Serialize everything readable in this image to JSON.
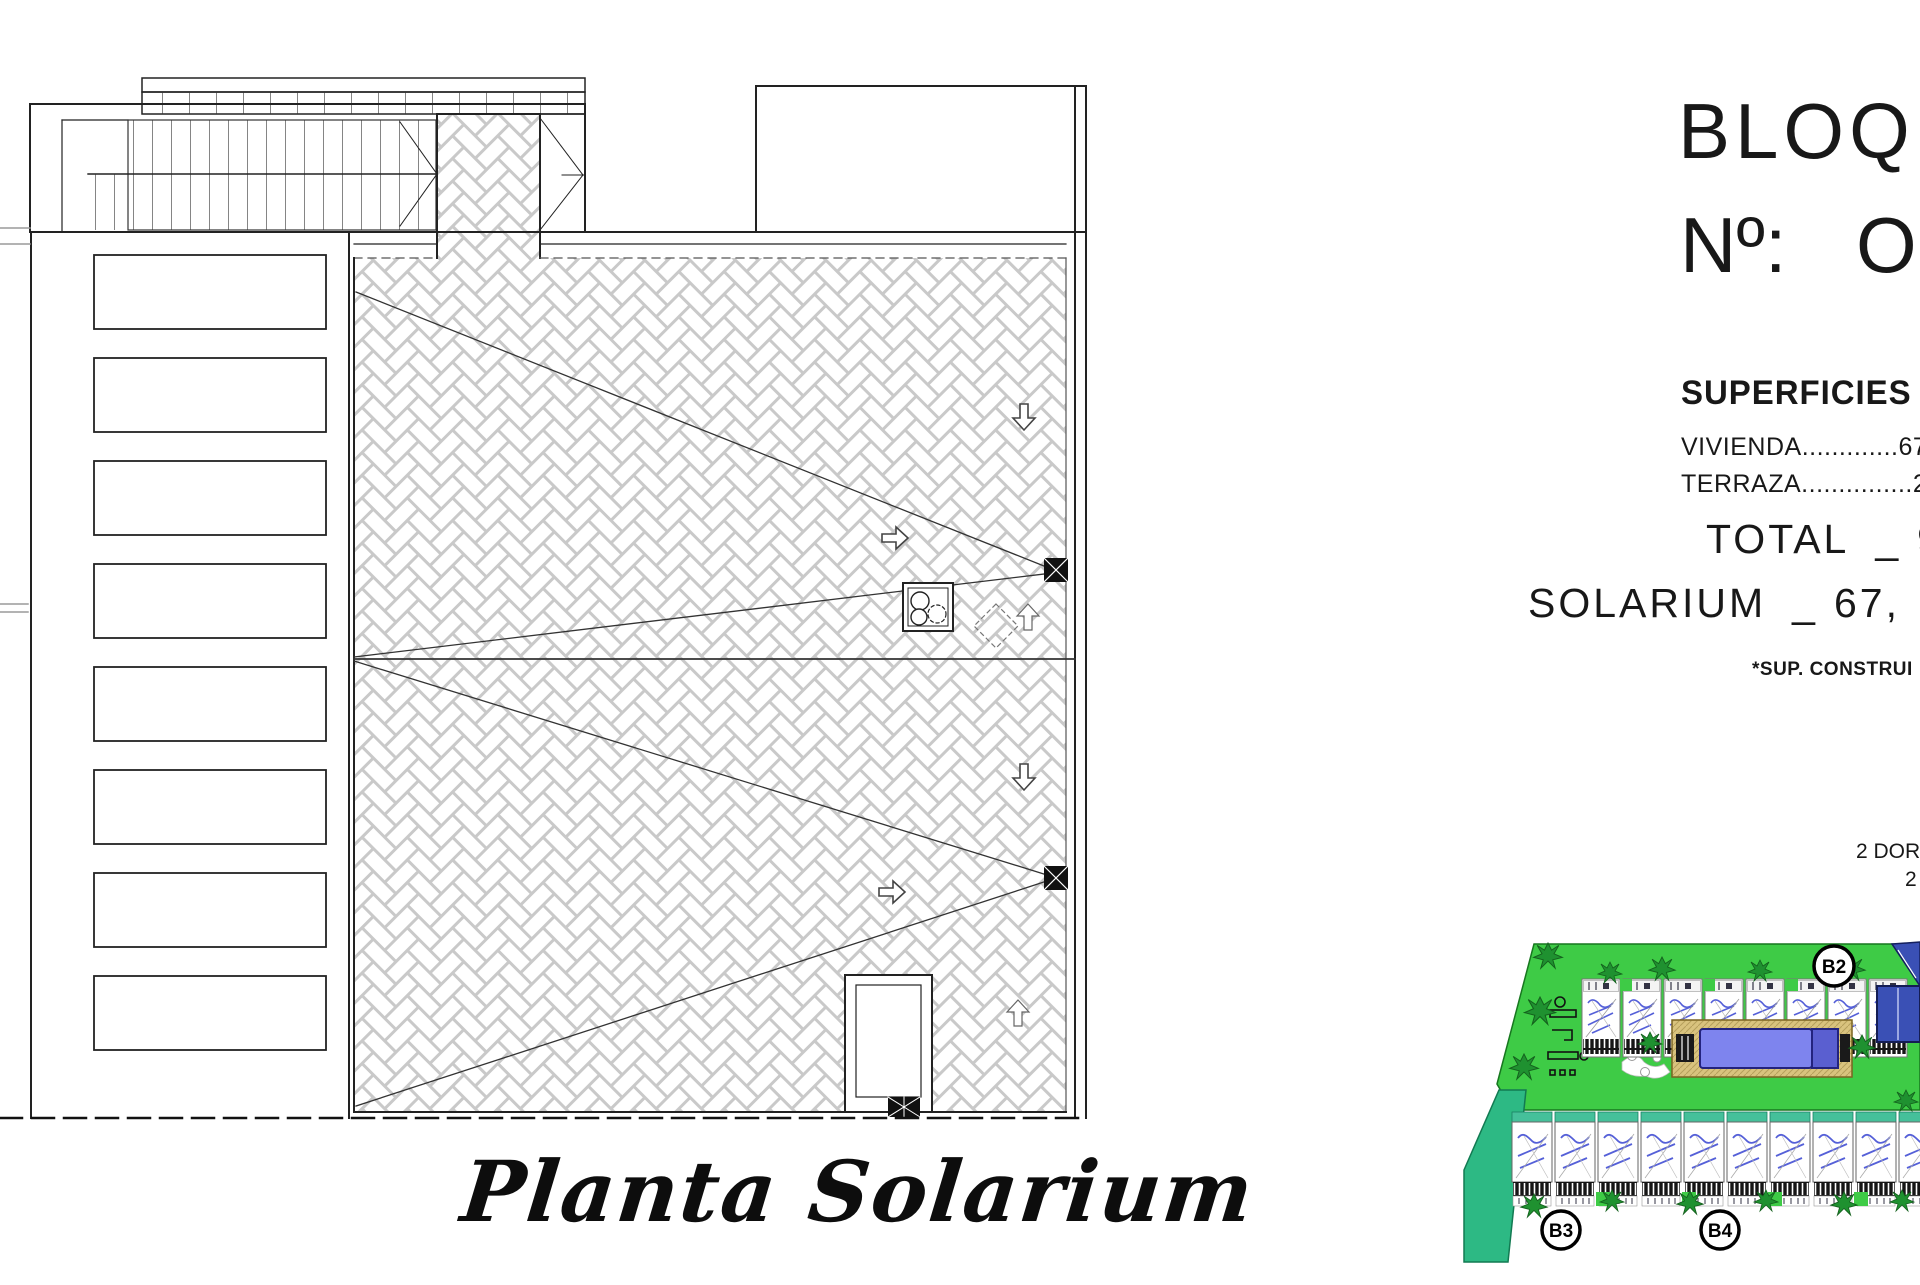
{
  "plan": {
    "caption": "Planta Solarium"
  },
  "info_panel": {
    "bloque_label": "BLOQ",
    "numero_label": "Nº:",
    "numero_value": "O",
    "superficies_label": "SUPERFICIES",
    "lines": [
      "VIVIENDA.............67",
      "TERRAZA...............27"
    ],
    "total": {
      "label": "TOTAL",
      "sep": "_",
      "value": "94"
    },
    "solarium": {
      "label": "SOLARIUM",
      "sep": "_",
      "value": "67,"
    },
    "note": "*SUP. CONSTRUI",
    "dorm_line_1": "2 DORM",
    "dorm_line_2": "2"
  },
  "site_plan": {
    "labels": {
      "b2": "B2",
      "b3": "B3",
      "b4": "B4"
    },
    "colors": {
      "lawn": "#3ecb46",
      "teal_wedge": "#2db984",
      "tree": "#1f9130",
      "pool": "#7e84ee",
      "pool_dark": "#5a5fd0",
      "deck": "#d9c37e",
      "navy": "#3a50b5",
      "unit_blue": "#5560d8",
      "cap_teal": "#45c09a"
    }
  }
}
